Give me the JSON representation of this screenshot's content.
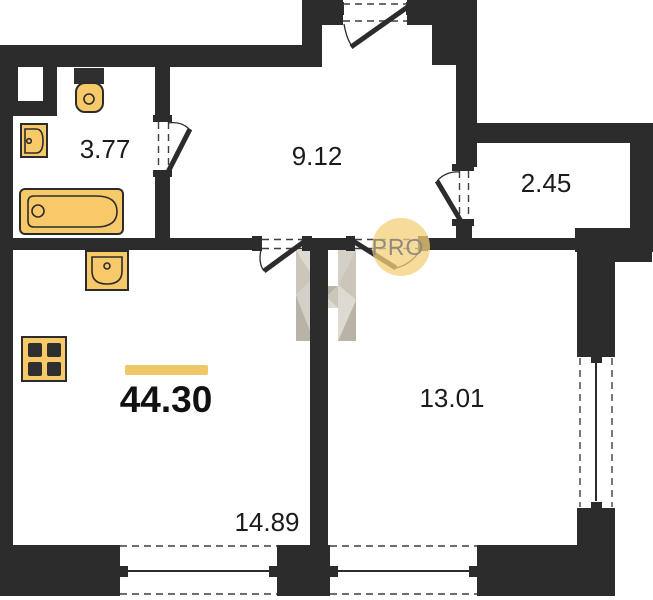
{
  "floorplan": {
    "total_area": "44.30",
    "rooms": {
      "bathroom_area": "3.77",
      "hallway_area": "9.12",
      "closet_area": "2.45",
      "bedroom_area": "13.01",
      "living_room_area": "14.89"
    },
    "watermark": {
      "badge_text": "PRO"
    },
    "colors": {
      "wall": "#2c2c2c",
      "fixture-fill": "#f8c968",
      "fixture-stroke": "#2c2c2c",
      "accent-bar": "#f0c766",
      "badge-fill": "#f4cf79",
      "badge-text": "#8f8a80",
      "label-text": "#1b1b1b"
    }
  }
}
